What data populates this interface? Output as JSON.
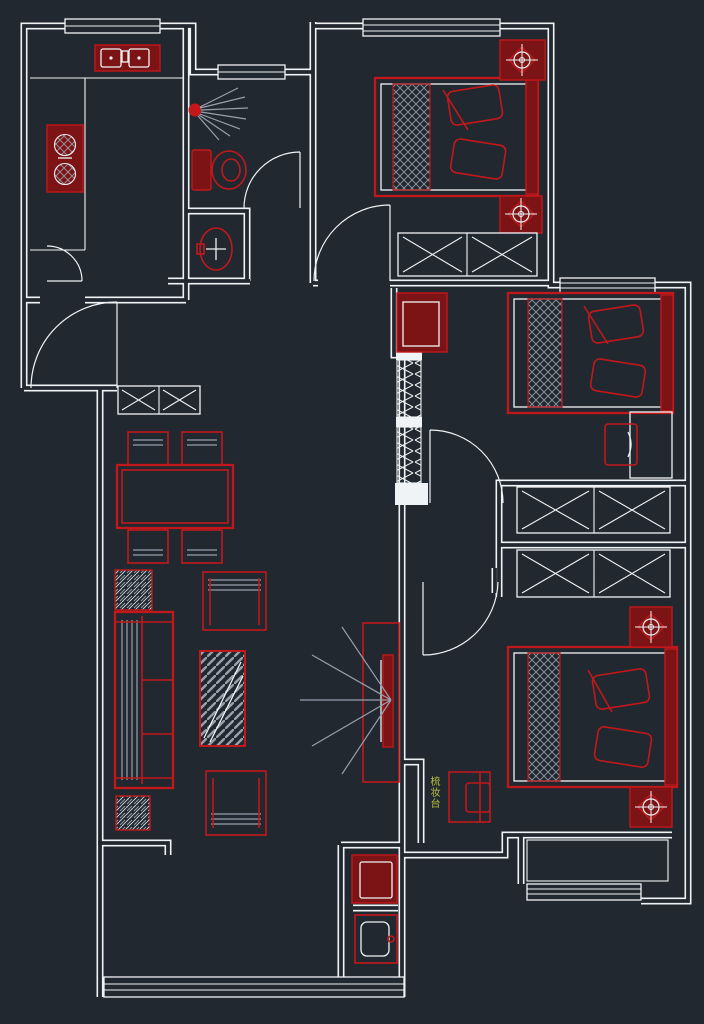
{
  "canvas": {
    "width": 704,
    "height": 1024,
    "viewbox": "0 0 704 1024",
    "background": "#212830"
  },
  "palette": {
    "bg": "#212830",
    "wall": "#f0f3f5",
    "red": "#c2181b",
    "maroon": "#7c1416",
    "gray": "#97a0ab",
    "yellow": "#bcbf3c"
  },
  "labels": {
    "dressing_table": "梳妆台"
  }
}
